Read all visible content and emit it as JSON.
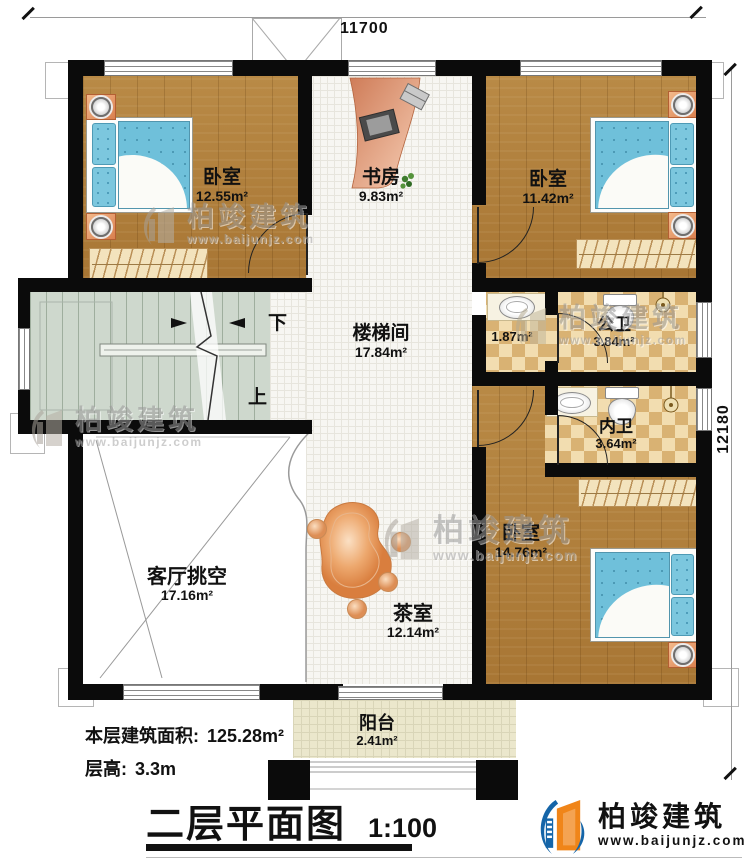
{
  "dimensions": {
    "top": "11700",
    "right": "12180"
  },
  "rooms": [
    {
      "id": "bedroom-top-left",
      "name": "卧室",
      "area": "12.55m²"
    },
    {
      "id": "study",
      "name": "书房",
      "area": "9.83m²"
    },
    {
      "id": "bedroom-top-right",
      "name": "卧室",
      "area": "11.42m²"
    },
    {
      "id": "stair-hall",
      "name": "楼梯间",
      "area": "17.84m²"
    },
    {
      "id": "wash-area",
      "name": "",
      "area": "1.87m²"
    },
    {
      "id": "public-bath",
      "name": "公卫",
      "area": "3.84m²"
    },
    {
      "id": "private-bath",
      "name": "内卫",
      "area": "3.64m²"
    },
    {
      "id": "bedroom-bottom-right",
      "name": "卧室",
      "area": "14.76m²"
    },
    {
      "id": "living-void",
      "name": "客厅挑空",
      "area": "17.16m²"
    },
    {
      "id": "tea-room",
      "name": "茶室",
      "area": "12.14m²"
    },
    {
      "id": "balcony",
      "name": "阳台",
      "area": "2.41m²"
    }
  ],
  "stairs": {
    "down": "下",
    "up": "上"
  },
  "footer": {
    "area_label": "本层建筑面积:",
    "area_value": "125.28m²",
    "height_label": "层高:",
    "height_value": "3.3m",
    "title": "二层平面图",
    "scale": "1:100"
  },
  "brand": {
    "name": "柏竣建筑",
    "site": "www.baijunjz.com"
  },
  "watermark": {
    "name": "柏竣建筑",
    "site": "www.baijunjz.com"
  },
  "colors": {
    "wall": "#0b0b0b",
    "wood": "#b2813f",
    "tile": "#f7f6f2",
    "checker_light": "#f2ddb0",
    "checker_dark": "#d9b273",
    "stair": "#ced8cd",
    "balcony": "#ebe7cc",
    "bed_blue": "#6fc0da",
    "brand_blue": "#1565a8",
    "brand_orange": "#f08519"
  }
}
